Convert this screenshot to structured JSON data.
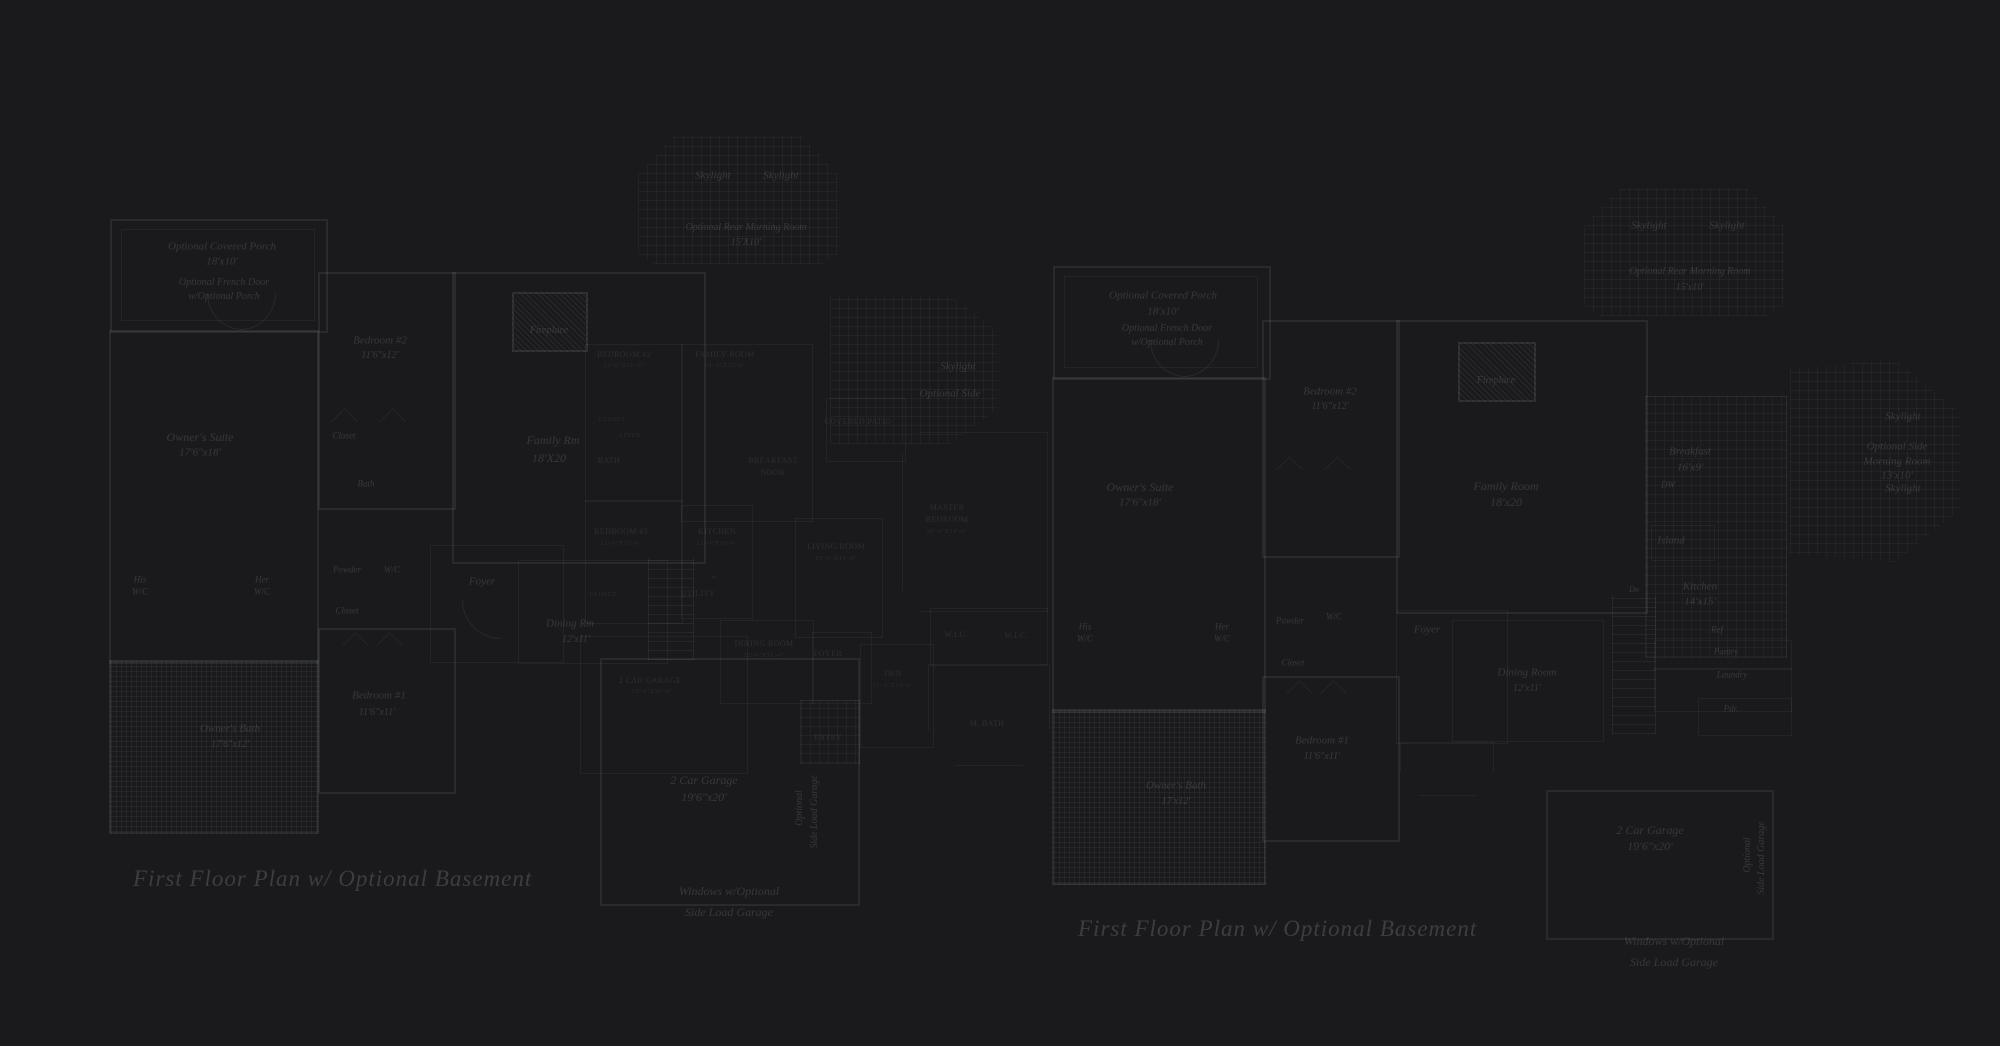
{
  "colors": {
    "background": "#1a1a1c",
    "line": "#2c2c30",
    "text": "#3c3e44"
  },
  "captions": {
    "left": "First Floor Plan  w/ Optional Basement",
    "right": "First Floor Plan  w/ Optional Basement"
  },
  "pl": {
    "porch": "Optional Covered Porch",
    "porch_dim": "18'x10'",
    "french1": "Optional French Door",
    "french2": "w/Optional Porch",
    "owners_suite": "Owner's Suite",
    "owners_suite_dim": "17'6\"x18'",
    "bedroom2": "Bedroom #2",
    "bedroom2_dim": "11'6\"x12'",
    "closet_upper": "Closet",
    "bath": "Bath",
    "his": "His",
    "his2": "W/C",
    "her": "Her",
    "her2": "W/C",
    "powder": "Powder",
    "wc": "W/C",
    "closet_lower": "Closet",
    "foyer": "Foyer",
    "dining": "Dining Rm",
    "dining_dim": "12'x11'",
    "bedroom1": "Bedroom #1",
    "bedroom1_dim": "11'6\"x11'",
    "owners_bath": "Owner's Bath",
    "owners_bath_dim": "17'6\"x12'",
    "fireplace": "Fireplace",
    "skylight1": "Skylight",
    "skylight2": "Skylight",
    "morning": "Optional Rear Morning Room",
    "morning_dim": "15'X10'",
    "family": "Family Rm",
    "family_dim": "18'X20",
    "skylight3": "Skylight",
    "opt_side": "Optional Side",
    "garage": "2 Car Garage",
    "garage_dim": "19'6\"x20'",
    "sideload1": "Optional",
    "sideload2": "Side Load Garage",
    "windows1": "Windows w/Optional",
    "windows2": "Side Load Garage"
  },
  "pm": {
    "bedroom2": "BEDROOM #2",
    "bedroom2_dim": "12'-0\"X11'-6\"",
    "family": "FAMILY ROOM",
    "family_dim": "19'-0\"X15'-8\"",
    "closet1": "CLOSET",
    "linen": "LINEN",
    "bath": "BATH",
    "breakfast1": "BREAKFAST",
    "breakfast2": "NOOK",
    "bedroom3": "BEDROOM #3",
    "bedroom3_dim": "12'-0\"X11'-0\"",
    "kitchen": "KITCHEN",
    "kitchen_dim": "12'-0\"X10'-0\"",
    "living": "LIVING ROOM",
    "living_dim": "15'-0\"X13'-0\"",
    "closet2": "CLOSET",
    "w": "W",
    "utility": "UTILITY",
    "dining": "DINING ROOM",
    "dining_dim": "12'-0\"X11'-0\"",
    "foyer": "FOYER",
    "entry": "ENTRY",
    "den": "DEN",
    "den_dim": "11'-0\"X10'-0\"",
    "wic1": "W.I.C.",
    "wic2": "W.I.C.",
    "mbath": "M. BATH",
    "master1": "MASTER",
    "master2": "BEDROOM",
    "master3": "16'-0\"X14'-0\"",
    "patio": "COVERED PATIO",
    "garage": "2 CAR GARAGE",
    "garage_dim": "19'-4\"X20'-0\""
  },
  "pr": {
    "porch": "Optional Covered Porch",
    "porch_dim": "18'x10'",
    "french1": "Optional French Door",
    "french2": "w/Optional Porch",
    "owners_suite": "Owner's Suite",
    "owners_suite_dim": "17'6\"x18'",
    "bedroom2": "Bedroom #2",
    "bedroom2_dim": "11'6\"x12'",
    "fireplace": "Fireplace",
    "skylight1": "Skylight",
    "skylight2": "Skylight",
    "morning": "Optional Rear Morning Room",
    "morning_dim": "15'x10'",
    "family": "Family Room",
    "family_dim": "18'x20",
    "breakfast": "Breakfast",
    "breakfast_dim": "16'x9'",
    "dw": "DW",
    "island": "Island",
    "kitchen": "Kitchen",
    "kitchen_dim": "14'x15'",
    "ref": "Ref",
    "pantry": "Pantry",
    "laundry": "Laundry",
    "pdr": "Pdr.",
    "dn": "Dn",
    "his": "His",
    "his2": "W/C",
    "her": "Her",
    "her2": "W/C",
    "powder": "Powder",
    "wc": "W/C",
    "closet_lower": "Closet",
    "foyer": "Foyer",
    "dining": "Dining Room",
    "dining_dim": "12'x11'",
    "bedroom1": "Bedroom #1",
    "bedroom1_dim": "11'6\"x11'",
    "owners_bath": "Owner's Bath",
    "owners_bath_dim": "17'x12'",
    "side_sky1": "Skylight",
    "side_m1": "Optional Side",
    "side_m2": "Morning Room",
    "side_m3": "13'x10'",
    "side_sky2": "Skylight",
    "garage": "2 Car Garage",
    "garage_dim": "19'6\"x20'",
    "sideload1": "Optional",
    "sideload2": "Side Load Garage",
    "windows1": "Windows w/Optional",
    "windows2": "Side Load Garage"
  }
}
